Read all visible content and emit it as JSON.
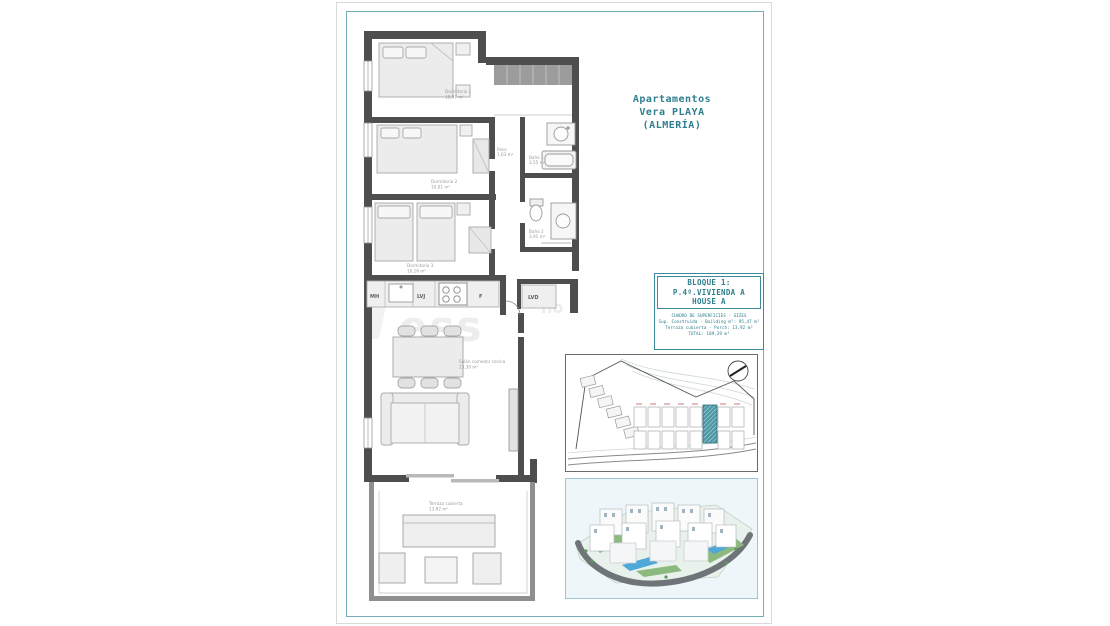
{
  "title": {
    "lines": [
      "Apartamentos",
      "Vera PLAYA",
      "(ALMERÍA)"
    ]
  },
  "info_box": {
    "header": [
      "BLOQUE 1:",
      "P.4º.VIVIENDA A",
      "HOUSE A"
    ],
    "table": [
      "CUADRO DE SUPERFICIES - SIZES",
      "Sup. Construida - Building m²: 95,47 m²",
      "Terraza cubierta - Porch: 13,92 m²",
      "TOTAL: 109,39 m²"
    ]
  },
  "plan": {
    "rooms": [
      {
        "name": "Dormitorio 1",
        "area": "10,97 m²"
      },
      {
        "name": "Dormitorio 2",
        "area": "10,01 m²"
      },
      {
        "name": "Dormitorio 3",
        "area": "10,16 m²"
      },
      {
        "name": "Paso",
        "area": "1,63 m²"
      },
      {
        "name": "Baño 1",
        "area": "3,55 m²"
      },
      {
        "name": "Baño 2",
        "area": "3,91 m²"
      },
      {
        "name": "Salón comedor cocina",
        "area": "23,30 m²"
      },
      {
        "name": "Terraza cubierta",
        "area": "13,92 m²"
      }
    ],
    "appliances": {
      "mh": "MH",
      "lvj": "LVJ",
      "f": "F",
      "lvd": "LVD"
    },
    "watermark": "ess"
  },
  "colors": {
    "accent": "#2e7f8e",
    "frame": "#73aeb8",
    "wall": "#4e4e4e",
    "site_highlight": "#4e98a5",
    "pool": "#4fa8d8"
  }
}
